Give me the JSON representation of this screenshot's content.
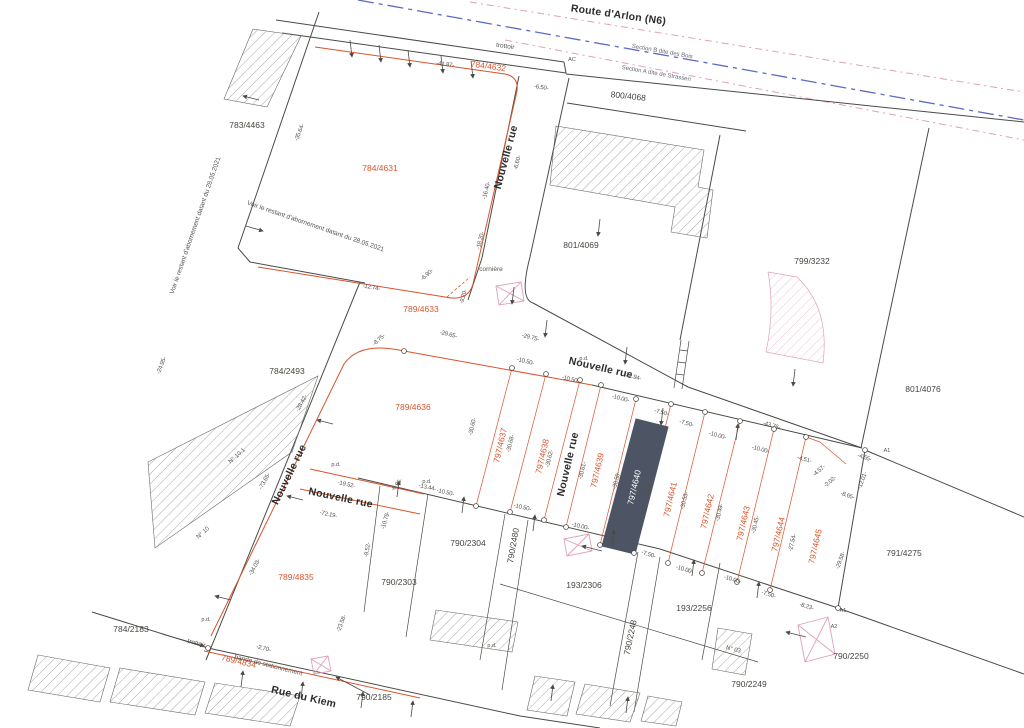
{
  "title": "Plan cadastral",
  "highlight_parcel": "797/4640",
  "colors": {
    "lot": "#d9542b",
    "hl": "#4d5464",
    "axis": "#5b6cc0",
    "pink": "#dfa0bd",
    "ink": "#4a4a46"
  },
  "labels": [
    {
      "t": "Route d'Arlon (N6)",
      "x": 618,
      "y": 18,
      "r": 8,
      "c": "street",
      "s": 13
    },
    {
      "t": "Nouvelle rue",
      "x": 509,
      "y": 158,
      "r": -75,
      "c": "street"
    },
    {
      "t": "Nouvelle rue",
      "x": 600,
      "y": 371,
      "r": 13,
      "c": "street"
    },
    {
      "t": "Nouvelle rue",
      "x": 292,
      "y": 476,
      "r": -64,
      "c": "street"
    },
    {
      "t": "Nouvelle rue",
      "x": 340,
      "y": 501,
      "r": 12,
      "c": "street",
      "s": 9.5
    },
    {
      "t": "Nouvelle rue",
      "x": 571,
      "y": 465,
      "r": -77,
      "c": "street",
      "s": 9.5
    },
    {
      "t": "Rue du Kiem",
      "x": 303,
      "y": 700,
      "r": 13,
      "c": "street",
      "s": 12
    },
    {
      "t": "Section B dite des Bois",
      "x": 662,
      "y": 53,
      "r": 10,
      "c": "sec"
    },
    {
      "t": "Section A dite de Strassen",
      "x": 656,
      "y": 75,
      "r": 10,
      "c": "sec"
    },
    {
      "t": "783/4463",
      "x": 247,
      "y": 128,
      "r": 0,
      "c": "parcel"
    },
    {
      "t": "800/4068",
      "x": 628,
      "y": 99,
      "r": 6,
      "c": "parcel"
    },
    {
      "t": "801/4069",
      "x": 581,
      "y": 248,
      "r": 0,
      "c": "parcel"
    },
    {
      "t": "799/3232",
      "x": 812,
      "y": 264,
      "r": 0,
      "c": "parcel"
    },
    {
      "t": "801/4076",
      "x": 923,
      "y": 392,
      "r": 0,
      "c": "parcel"
    },
    {
      "t": "784/2493",
      "x": 287,
      "y": 374,
      "r": 0,
      "c": "parcel"
    },
    {
      "t": "790/2304",
      "x": 468,
      "y": 546,
      "r": 0,
      "c": "parcel"
    },
    {
      "t": "790/2303",
      "x": 399,
      "y": 585,
      "r": 0,
      "c": "parcel"
    },
    {
      "t": "790/2480",
      "x": 516,
      "y": 546,
      "r": -80,
      "c": "parcel"
    },
    {
      "t": "193/2306",
      "x": 584,
      "y": 588,
      "r": 0,
      "c": "parcel"
    },
    {
      "t": "193/2256",
      "x": 694,
      "y": 611,
      "r": 0,
      "c": "parcel"
    },
    {
      "t": "790/2248",
      "x": 633,
      "y": 638,
      "r": -78,
      "c": "parcel"
    },
    {
      "t": "790/2249",
      "x": 749,
      "y": 687,
      "r": 0,
      "c": "parcel"
    },
    {
      "t": "790/2250",
      "x": 851,
      "y": 659,
      "r": 0,
      "c": "parcel"
    },
    {
      "t": "791/4275",
      "x": 904,
      "y": 556,
      "r": 0,
      "c": "parcel"
    },
    {
      "t": "784/2183",
      "x": 131,
      "y": 632,
      "r": 0,
      "c": "parcel"
    },
    {
      "t": "790/2185",
      "x": 374,
      "y": 700,
      "r": 0,
      "c": "parcel"
    },
    {
      "t": "784/4632",
      "x": 488,
      "y": 69,
      "r": 8,
      "c": "lot"
    },
    {
      "t": "784/4631",
      "x": 380,
      "y": 171,
      "r": 0,
      "c": "lot"
    },
    {
      "t": "789/4633",
      "x": 421,
      "y": 312,
      "r": 0,
      "c": "lot"
    },
    {
      "t": "789/4636",
      "x": 413,
      "y": 410,
      "r": 0,
      "c": "lot"
    },
    {
      "t": "797/4637",
      "x": 503,
      "y": 446,
      "r": -77,
      "c": "lot"
    },
    {
      "t": "797/4638",
      "x": 545,
      "y": 457,
      "r": -77,
      "c": "lot"
    },
    {
      "t": "797/4639",
      "x": 600,
      "y": 471,
      "r": -77,
      "c": "lot"
    },
    {
      "t": "797/4640",
      "x": 637,
      "y": 488,
      "r": -77,
      "c": "lotw"
    },
    {
      "t": "797/4641",
      "x": 673,
      "y": 500,
      "r": -77,
      "c": "lot"
    },
    {
      "t": "797/4642",
      "x": 710,
      "y": 512,
      "r": -77,
      "c": "lot"
    },
    {
      "t": "797/4643",
      "x": 746,
      "y": 524,
      "r": -77,
      "c": "lot"
    },
    {
      "t": "797/4644",
      "x": 781,
      "y": 535,
      "r": -77,
      "c": "lot"
    },
    {
      "t": "797/4645",
      "x": 818,
      "y": 547,
      "r": -77,
      "c": "lot"
    },
    {
      "t": "789/4835",
      "x": 296,
      "y": 580,
      "r": 0,
      "c": "lot"
    },
    {
      "t": "789/4834",
      "x": 238,
      "y": 664,
      "r": 13,
      "c": "lot"
    },
    {
      "t": "trottoir",
      "x": 505,
      "y": 48,
      "r": 8,
      "c": "note"
    },
    {
      "t": "trottoir",
      "x": 196,
      "y": 645,
      "r": 15,
      "c": "note"
    },
    {
      "t": "bande de stationnement",
      "x": 268,
      "y": 667,
      "r": 14,
      "c": "note"
    },
    {
      "t": "cornière",
      "x": 491,
      "y": 271,
      "r": 0,
      "c": "note"
    },
    {
      "t": "Voir le restant d'abornement datant du 28.05.2021",
      "x": 197,
      "y": 226,
      "r": -71,
      "c": "note",
      "s": 5.5
    },
    {
      "t": "Voir le restant d'abornement datant du 28.05.2021",
      "x": 315,
      "y": 228,
      "r": 19,
      "c": "note",
      "s": 5.5
    },
    {
      "t": "N° 10.1",
      "x": 238,
      "y": 457,
      "r": -42,
      "c": "bldg"
    },
    {
      "t": "N° 10",
      "x": 204,
      "y": 534,
      "r": -42,
      "c": "bldg"
    },
    {
      "t": "N° 03",
      "x": 733,
      "y": 651,
      "r": 14,
      "c": "bldg"
    },
    {
      "t": "AC",
      "x": 572,
      "y": 61,
      "r": 0,
      "c": "tiny"
    },
    {
      "t": "A1",
      "x": 887,
      "y": 452,
      "r": 0,
      "c": "tiny"
    },
    {
      "t": "A1",
      "x": 843,
      "y": 612,
      "r": 0,
      "c": "tiny"
    },
    {
      "t": "A2",
      "x": 834,
      "y": 628,
      "r": 0,
      "c": "tiny"
    },
    {
      "t": "-41.87-",
      "x": 445,
      "y": 66,
      "r": 8,
      "c": "dim"
    },
    {
      "t": "-6.50-",
      "x": 541,
      "y": 89,
      "r": 8,
      "c": "dim"
    },
    {
      "t": "-35.64-",
      "x": 301,
      "y": 133,
      "r": -69,
      "c": "dim"
    },
    {
      "t": "-24.95-",
      "x": 163,
      "y": 366,
      "r": -69,
      "c": "dim"
    },
    {
      "t": "-16.40-",
      "x": 488,
      "y": 191,
      "r": -76,
      "c": "dim"
    },
    {
      "t": "-18.20-",
      "x": 482,
      "y": 241,
      "r": -76,
      "c": "dim"
    },
    {
      "t": "-6.60-",
      "x": 519,
      "y": 163,
      "r": -76,
      "c": "dim"
    },
    {
      "t": "-12.74-",
      "x": 371,
      "y": 289,
      "r": 11,
      "c": "dim"
    },
    {
      "t": "-6.90-",
      "x": 428,
      "y": 276,
      "r": -42,
      "c": "dim"
    },
    {
      "t": "-9.20-",
      "x": 465,
      "y": 297,
      "r": -76,
      "c": "dim"
    },
    {
      "t": "-8.75-",
      "x": 380,
      "y": 341,
      "r": -42,
      "c": "dim"
    },
    {
      "t": "-29.65-",
      "x": 448,
      "y": 336,
      "r": 14,
      "c": "dim"
    },
    {
      "t": "-29.75-",
      "x": 530,
      "y": 339,
      "r": 14,
      "c": "dim"
    },
    {
      "t": "-22.94-",
      "x": 632,
      "y": 378,
      "r": 17,
      "c": "dim"
    },
    {
      "t": "-43.76-",
      "x": 771,
      "y": 427,
      "r": 17,
      "c": "dim"
    },
    {
      "t": "-10.50-",
      "x": 525,
      "y": 363,
      "r": 14,
      "c": "dim"
    },
    {
      "t": "-10.50-",
      "x": 570,
      "y": 381,
      "r": 14,
      "c": "dim"
    },
    {
      "t": "-10.00-",
      "x": 620,
      "y": 400,
      "r": 15,
      "c": "dim"
    },
    {
      "t": "-7.50-",
      "x": 661,
      "y": 414,
      "r": 15,
      "c": "dim"
    },
    {
      "t": "-7.50-",
      "x": 686,
      "y": 425,
      "r": 15,
      "c": "dim"
    },
    {
      "t": "-10.00-",
      "x": 717,
      "y": 437,
      "r": 15,
      "c": "dim"
    },
    {
      "t": "-10.00-",
      "x": 760,
      "y": 451,
      "r": 15,
      "c": "dim"
    },
    {
      "t": "-4.51-",
      "x": 804,
      "y": 461,
      "r": 15,
      "c": "dim"
    },
    {
      "t": "-4.57-",
      "x": 820,
      "y": 472,
      "r": -40,
      "c": "dim"
    },
    {
      "t": "-2.02-",
      "x": 831,
      "y": 483,
      "r": -40,
      "c": "dim"
    },
    {
      "t": "-8.65-",
      "x": 847,
      "y": 497,
      "r": 18,
      "c": "dim"
    },
    {
      "t": "-4.55-",
      "x": 864,
      "y": 459,
      "r": 18,
      "c": "dim"
    },
    {
      "t": "-12.01-",
      "x": 864,
      "y": 481,
      "r": -70,
      "c": "dim"
    },
    {
      "t": "-30.60-",
      "x": 474,
      "y": 427,
      "r": -77,
      "c": "dim"
    },
    {
      "t": "-30.68-",
      "x": 512,
      "y": 444,
      "r": -77,
      "c": "dim"
    },
    {
      "t": "-30.62-",
      "x": 551,
      "y": 459,
      "r": -77,
      "c": "dim"
    },
    {
      "t": "-30.61-",
      "x": 584,
      "y": 471,
      "r": -77,
      "c": "dim"
    },
    {
      "t": "-30.58-",
      "x": 618,
      "y": 481,
      "r": -77,
      "c": "dim"
    },
    {
      "t": "-30.56-",
      "x": 650,
      "y": 490,
      "r": -77,
      "c": "dim"
    },
    {
      "t": "-30.53-",
      "x": 686,
      "y": 501,
      "r": -77,
      "c": "dim"
    },
    {
      "t": "-30.49-",
      "x": 721,
      "y": 513,
      "r": -77,
      "c": "dim"
    },
    {
      "t": "-30.45-",
      "x": 757,
      "y": 525,
      "r": -77,
      "c": "dim"
    },
    {
      "t": "-27.54-",
      "x": 794,
      "y": 543,
      "r": -77,
      "c": "dim"
    },
    {
      "t": "-29.58-",
      "x": 842,
      "y": 561,
      "r": -70,
      "c": "dim"
    },
    {
      "t": "-10.50-",
      "x": 445,
      "y": 494,
      "r": 13,
      "c": "dim"
    },
    {
      "t": "-10.50-",
      "x": 522,
      "y": 509,
      "r": 13,
      "c": "dim"
    },
    {
      "t": "-10.00-",
      "x": 580,
      "y": 528,
      "r": 13,
      "c": "dim"
    },
    {
      "t": "-7.50-",
      "x": 648,
      "y": 556,
      "r": 17,
      "c": "dim"
    },
    {
      "t": "-10.00-",
      "x": 684,
      "y": 571,
      "r": 17,
      "c": "dim"
    },
    {
      "t": "-10.00-",
      "x": 732,
      "y": 581,
      "r": 17,
      "c": "dim"
    },
    {
      "t": "-7.50-",
      "x": 768,
      "y": 596,
      "r": 17,
      "c": "dim"
    },
    {
      "t": "-8.23-",
      "x": 806,
      "y": 608,
      "r": 17,
      "c": "dim"
    },
    {
      "t": "-73.65-",
      "x": 266,
      "y": 482,
      "r": -61,
      "c": "dim"
    },
    {
      "t": "-34.03-",
      "x": 256,
      "y": 568,
      "r": -61,
      "c": "dim"
    },
    {
      "t": "-28.42-",
      "x": 303,
      "y": 404,
      "r": -61,
      "c": "dim"
    },
    {
      "t": "-19.52-",
      "x": 346,
      "y": 486,
      "r": 12,
      "c": "dim"
    },
    {
      "t": "-72.19-",
      "x": 328,
      "y": 516,
      "r": 12,
      "c": "dim"
    },
    {
      "t": "-9.52-",
      "x": 369,
      "y": 550,
      "r": -80,
      "c": "dim"
    },
    {
      "t": "-10.79-",
      "x": 387,
      "y": 521,
      "r": -73,
      "c": "dim"
    },
    {
      "t": "-6.95-",
      "x": 398,
      "y": 486,
      "r": -50,
      "c": "dim"
    },
    {
      "t": "-13.44-",
      "x": 427,
      "y": 489,
      "r": 12,
      "c": "dim"
    },
    {
      "t": "-23.58-",
      "x": 343,
      "y": 624,
      "r": -70,
      "c": "dim"
    },
    {
      "t": "-2.70-",
      "x": 263,
      "y": 650,
      "r": 14,
      "c": "dim"
    },
    {
      "t": "p.d.",
      "x": 336,
      "y": 466,
      "r": 0,
      "c": "tiny"
    },
    {
      "t": "p.d.",
      "x": 427,
      "y": 483,
      "r": 0,
      "c": "tiny"
    },
    {
      "t": "p.d.",
      "x": 584,
      "y": 360,
      "r": 0,
      "c": "tiny"
    },
    {
      "t": "p.d.",
      "x": 206,
      "y": 621,
      "r": 0,
      "c": "tiny"
    },
    {
      "t": "p.d.",
      "x": 492,
      "y": 647,
      "r": 0,
      "c": "tiny"
    }
  ]
}
